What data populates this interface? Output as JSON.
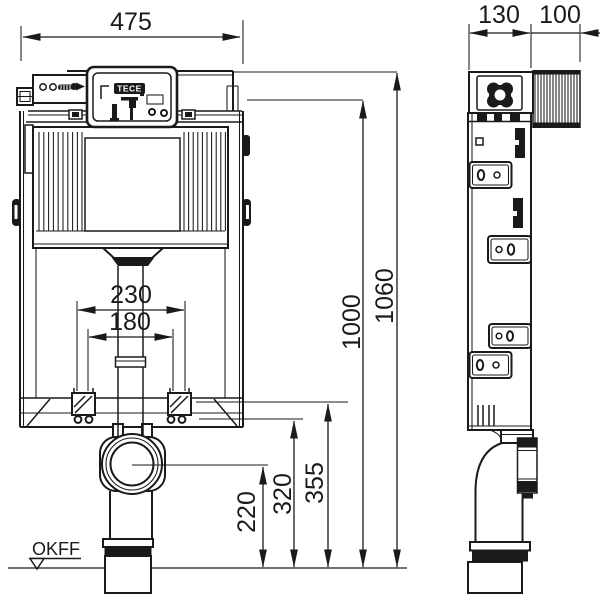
{
  "labels": {
    "brand_logo": "TECE",
    "floor_level_marker": "OKFF"
  },
  "dimensions_mm": {
    "overall_width": "475",
    "frame_depth": "130",
    "wall_thickness": "100",
    "total_height": "1060",
    "frame_height": "1000",
    "fixing_spacing_outer": "230",
    "fixing_spacing_inner": "180",
    "drain_center_height": "220",
    "fixing_bolt_height": "320",
    "frame_base_height": "355"
  }
}
